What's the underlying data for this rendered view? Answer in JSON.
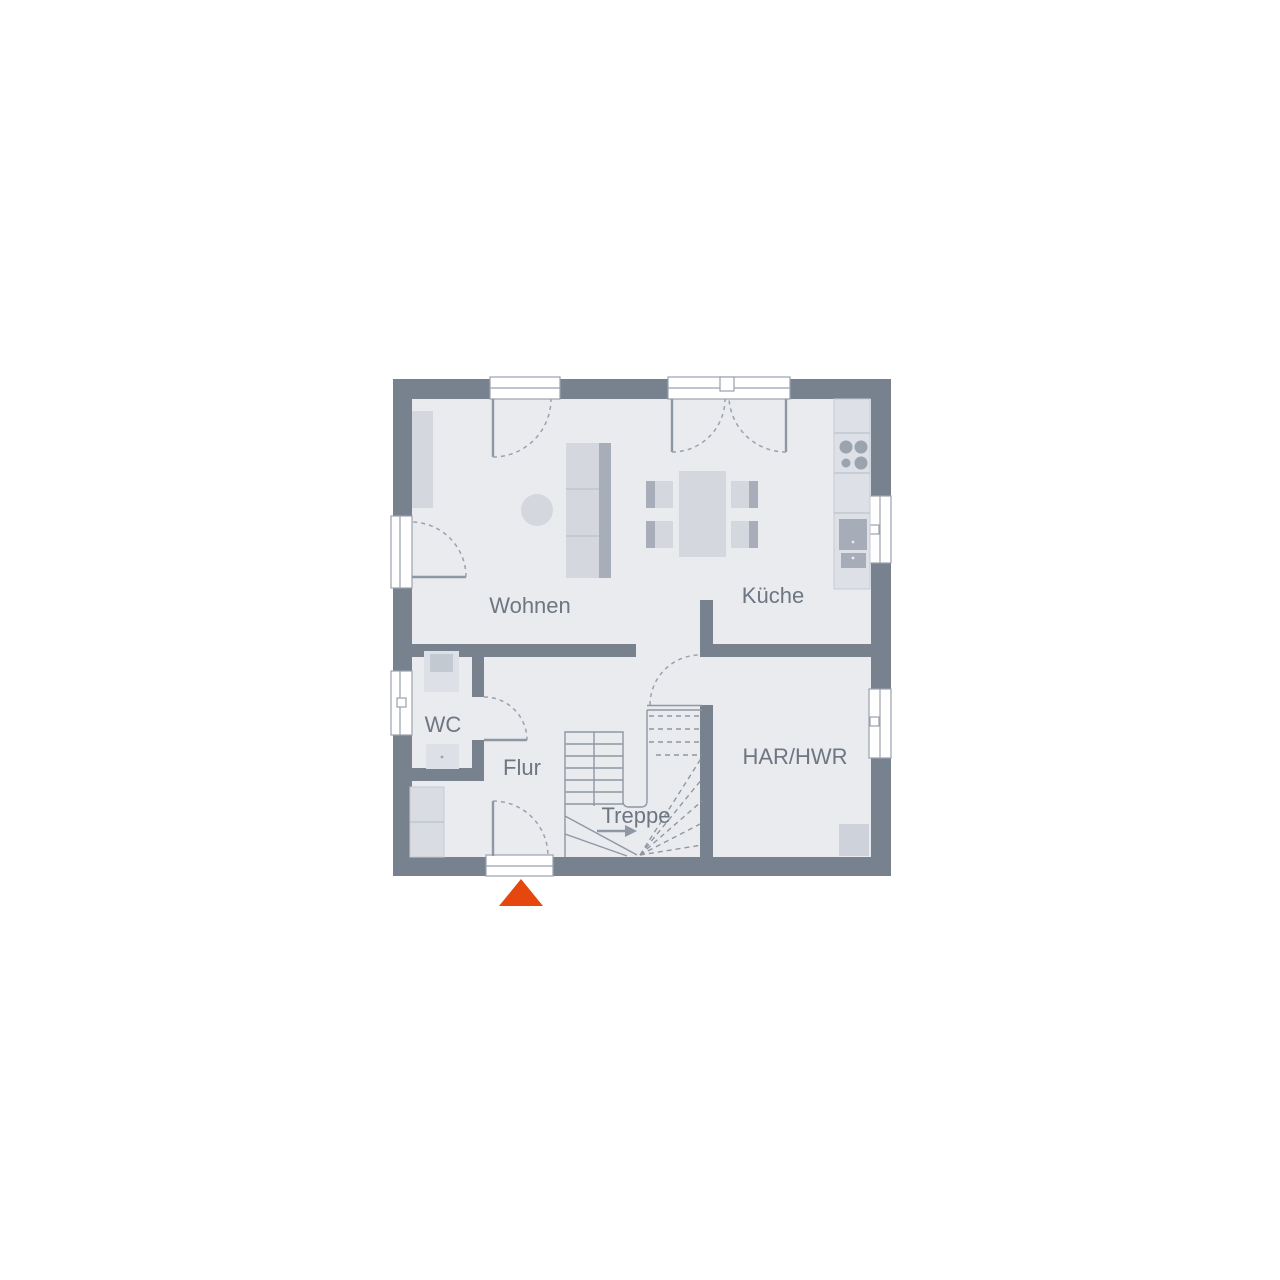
{
  "plan": {
    "type": "floor-plan",
    "floor": "Erdgeschoss"
  },
  "colors": {
    "wall": "#78828f",
    "floor": "#e9ebef",
    "label": "#6d7681",
    "furniture_light": "#d4d7de",
    "furniture_dark": "#a7aeb9",
    "counter": "#dde0e6",
    "entrance_marker": "#e5470e",
    "background": "#ffffff"
  },
  "rooms": [
    {
      "id": "wohnen",
      "label": "Wohnen"
    },
    {
      "id": "kueche",
      "label": "Küche"
    },
    {
      "id": "wc",
      "label": "WC"
    },
    {
      "id": "flur",
      "label": "Flur"
    },
    {
      "id": "treppe",
      "label": "Treppe"
    },
    {
      "id": "har-hwr",
      "label": "HAR/HWR"
    }
  ],
  "entrance": {
    "shape": "triangle"
  }
}
